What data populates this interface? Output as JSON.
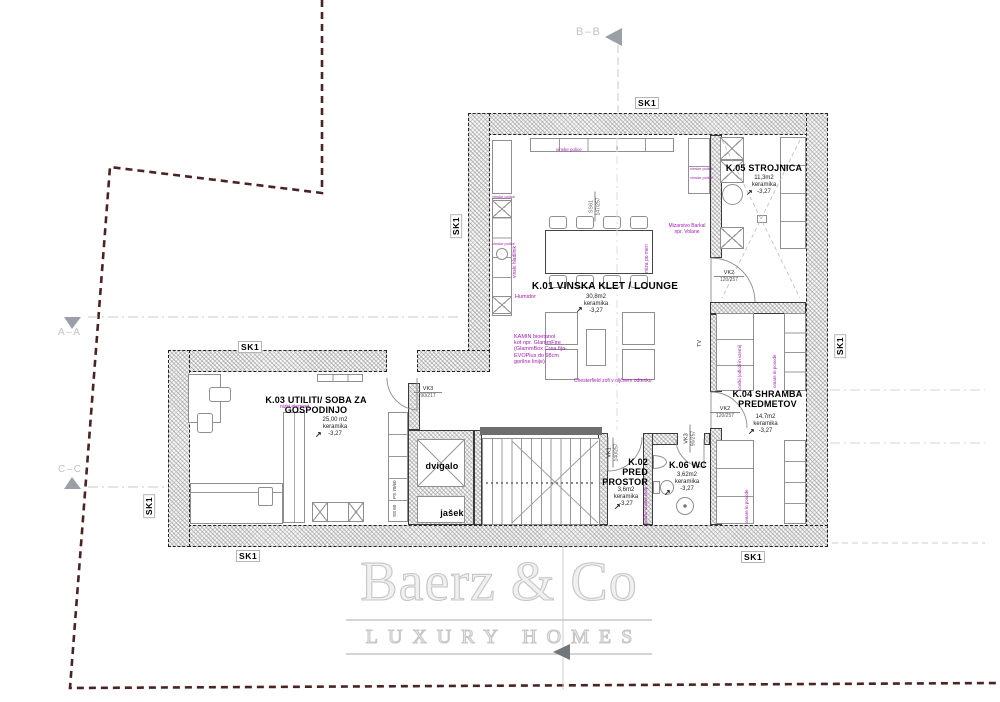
{
  "plan": {
    "wall_tag": "SK1",
    "sections": {
      "aa": "A–A",
      "bb": "B–B",
      "cc": "C–C"
    },
    "rooms": {
      "k01": {
        "name": "K.01 VINSKA KLET / LOUNGE",
        "area": "30,8m2",
        "finish": "keramika",
        "level": "-3,27"
      },
      "k02": {
        "name1": "K.02",
        "name2": "PRED",
        "name3": "PROSTOR",
        "area": "3,6m2",
        "finish": "keramika",
        "level": "-3,27"
      },
      "k03": {
        "name1": "K.03 UTILITI/ SOBA ZA",
        "name2": "GOSPODINJO",
        "area": "25,00 m2",
        "finish": "keramika",
        "level": "-3,27"
      },
      "k04": {
        "name1": "K.04 SHRAMBA",
        "name2": "PREDMETOV",
        "area": "14,7m2",
        "finish": "keramika",
        "level": "-3,27"
      },
      "k05": {
        "name": "K.05 STROJNICA",
        "area": "11,3m2",
        "finish": "keramika",
        "level": "-3,27"
      },
      "k06": {
        "name": "K.06 WC",
        "area": "3,62m2",
        "finish": "keramika",
        "level": "-3,27"
      }
    },
    "features": {
      "dvigalo": "dvigalo",
      "jasek": "jašek",
      "tv": "TV",
      "humidor": "Humidor",
      "ps": "PS 70/60",
      "ss": "SS 60"
    },
    "doors": {
      "vk1": {
        "code": "VK1",
        "size": "140/257"
      },
      "vk2_k05": {
        "code": "VK2",
        "size": "120/257"
      },
      "vk2_k04": {
        "code": "VK2",
        "size": "120/257"
      },
      "vk3_k03": {
        "code": "VK3",
        "size": "90/217"
      },
      "vk3_wc": {
        "code": "VK3",
        "size": "90/257"
      },
      "ss61": {
        "code": "SS61",
        "size": "147/257"
      }
    },
    "annotations": {
      "kamin1": "KAMIN bioetanol",
      "kamin2": "kot npr. GlammFire",
      "kamin3": "(GlammBox Crea fija-",
      "kamin4": "EVOPlus do 98cm",
      "kamin5": "gorilne linije)",
      "chesterfield": "Chesterfield zofi v oljčnem odtenku",
      "mizar1": "Mizarstvo Barkal",
      "mizar2": "npr. Volane",
      "vinski_hladilnik": "vinski hladilnik",
      "police": "vinske police",
      "miza": "miza po meri",
      "nizki_element": "nizki element",
      "kovcki": "kovčki (odloži in vzemi)",
      "posode": "omare in posode",
      "pralni": "pralno-sušilni stolp"
    },
    "icons": {
      "level_arrow": "↗"
    }
  },
  "watermark": {
    "brand": "Baerz & Co",
    "tagline": "LUXURY HOMES"
  },
  "colors": {
    "annotation": "#a21caf",
    "boundary": "#4a2323",
    "marker_gray": "#9aa0a6"
  }
}
